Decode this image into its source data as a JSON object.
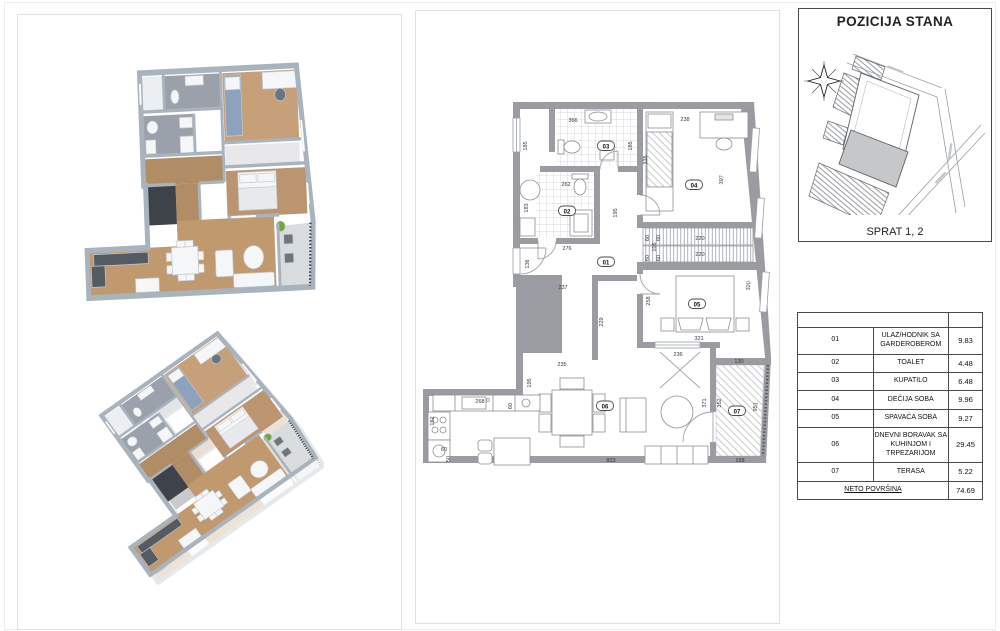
{
  "map_panel": {
    "title": "POZICIJA STANA",
    "floor_label": "SPRAT 1, 2"
  },
  "plan2d": {
    "room_labels": [
      {
        "n": "01",
        "x": 606,
        "y": 263
      },
      {
        "n": "02",
        "x": 567,
        "y": 212
      },
      {
        "n": "03",
        "x": 606,
        "y": 147
      },
      {
        "n": "04",
        "x": 694,
        "y": 186
      },
      {
        "n": "05",
        "x": 697,
        "y": 305
      },
      {
        "n": "06",
        "x": 605,
        "y": 407
      },
      {
        "n": "07",
        "x": 737,
        "y": 412
      }
    ],
    "dimensions": [
      {
        "t": "366",
        "x": 573,
        "y": 122,
        "r": 0
      },
      {
        "t": "185",
        "x": 527,
        "y": 146,
        "r": -90
      },
      {
        "t": "185",
        "x": 632,
        "y": 146,
        "r": -90
      },
      {
        "t": "238",
        "x": 685,
        "y": 121,
        "r": 0
      },
      {
        "t": "335",
        "x": 647,
        "y": 160,
        "r": -90
      },
      {
        "t": "397",
        "x": 723,
        "y": 180,
        "r": -85
      },
      {
        "t": "262",
        "x": 566,
        "y": 186,
        "r": 0
      },
      {
        "t": "183",
        "x": 528,
        "y": 208,
        "r": -90
      },
      {
        "t": "195",
        "x": 617,
        "y": 213,
        "r": -90
      },
      {
        "t": "276",
        "x": 567,
        "y": 250,
        "r": 0
      },
      {
        "t": "136",
        "x": 529,
        "y": 264,
        "r": -90
      },
      {
        "t": "237",
        "x": 563,
        "y": 289,
        "r": 0
      },
      {
        "t": "60",
        "x": 649,
        "y": 238,
        "r": -90
      },
      {
        "t": "105",
        "x": 656,
        "y": 247,
        "r": -90
      },
      {
        "t": "60",
        "x": 649,
        "y": 258,
        "r": -90
      },
      {
        "t": "60",
        "x": 660,
        "y": 238,
        "r": -90
      },
      {
        "t": "60",
        "x": 660,
        "y": 258,
        "r": -90
      },
      {
        "t": "220",
        "x": 700,
        "y": 240,
        "r": 0
      },
      {
        "t": "220",
        "x": 700,
        "y": 256,
        "r": 0
      },
      {
        "t": "229",
        "x": 603,
        "y": 322,
        "r": -90
      },
      {
        "t": "258",
        "x": 650,
        "y": 301,
        "r": -90
      },
      {
        "t": "321",
        "x": 699,
        "y": 340,
        "r": 0
      },
      {
        "t": "320",
        "x": 750,
        "y": 286,
        "r": -85
      },
      {
        "t": "236",
        "x": 678,
        "y": 356,
        "r": 0
      },
      {
        "t": "130",
        "x": 739,
        "y": 363,
        "r": 0
      },
      {
        "t": "371",
        "x": 706,
        "y": 403,
        "r": -90
      },
      {
        "t": "352",
        "x": 721,
        "y": 403,
        "r": -90
      },
      {
        "t": "951",
        "x": 757,
        "y": 407,
        "r": -85
      },
      {
        "t": "168",
        "x": 740,
        "y": 462,
        "r": 0
      },
      {
        "t": "235",
        "x": 562,
        "y": 366,
        "r": 0
      },
      {
        "t": "195",
        "x": 531,
        "y": 383,
        "r": -90
      },
      {
        "t": "268",
        "x": 480,
        "y": 403,
        "r": 0
      },
      {
        "t": "60",
        "x": 512,
        "y": 406,
        "r": -90
      },
      {
        "t": "152",
        "x": 434,
        "y": 421,
        "r": -90
      },
      {
        "t": "60",
        "x": 444,
        "y": 451,
        "r": 0
      },
      {
        "t": "50",
        "x": 450,
        "y": 459,
        "r": -90
      },
      {
        "t": "823",
        "x": 611,
        "y": 462,
        "r": 0
      }
    ]
  },
  "area_table": {
    "rows": [
      {
        "num": "01",
        "name": "ULAZ/HODNIK SA GARDEROBEROM",
        "area": "9.83"
      },
      {
        "num": "02",
        "name": "TOALET",
        "area": "4.48"
      },
      {
        "num": "03",
        "name": "KUPATILO",
        "area": "6.48"
      },
      {
        "num": "04",
        "name": "DEČIJA SOBA",
        "area": "9.96"
      },
      {
        "num": "05",
        "name": "SPAVAĆA SOBA",
        "area": "9.27"
      },
      {
        "num": "06",
        "name": "DNEVNI BORAVAK SA KUHINJOM I TRPEZARIJOM",
        "area": "29.45"
      },
      {
        "num": "07",
        "name": "TERASA",
        "area": "5.22"
      }
    ],
    "total_label": "NETO POVRŠINA",
    "total_area": "74.69"
  }
}
